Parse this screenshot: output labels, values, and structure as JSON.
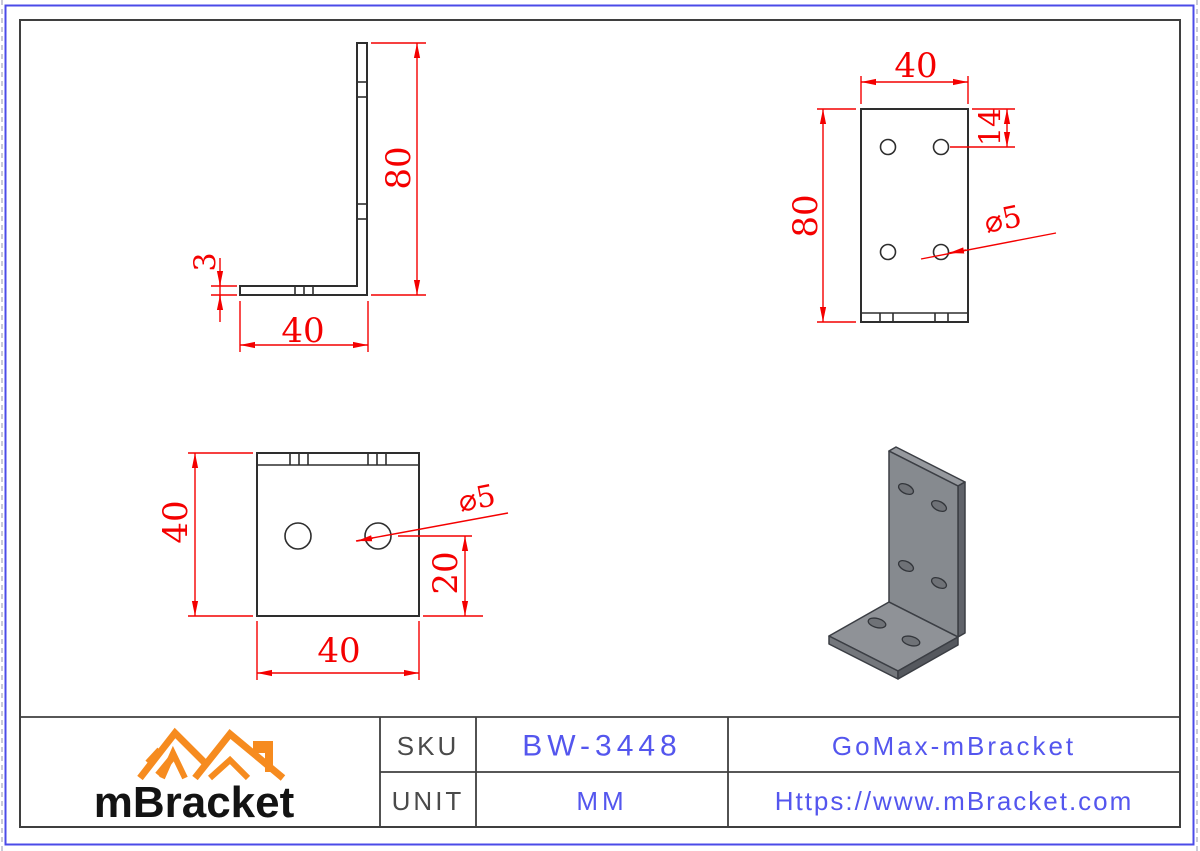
{
  "drawing": {
    "side_view": {
      "height": "80",
      "width": "40",
      "thickness": "3"
    },
    "front_view": {
      "top_width": "40",
      "height": "80",
      "hole_top_offset": "14",
      "hole_diameter": "⌀5"
    },
    "top_view": {
      "side": "40",
      "bottom_width": "40",
      "hole_diameter": "⌀5",
      "hole_bottom_offset": "20"
    }
  },
  "title_block": {
    "brand": "mBracket",
    "sku_label": "SKU",
    "sku_value": "BW-3448",
    "unit_label": "UNIT",
    "unit_value": "MM",
    "company": "GoMax-mBracket",
    "website": "Https://www.mBracket.com"
  },
  "colors": {
    "dimension_red": "#f40000",
    "part_line_dark": "#2e2e2e",
    "outer_frame_blue": "#4b4be8",
    "title_text_blue": "#5456ee",
    "logo_orange": "#f68b1f",
    "model_gray": "#868a8f"
  }
}
